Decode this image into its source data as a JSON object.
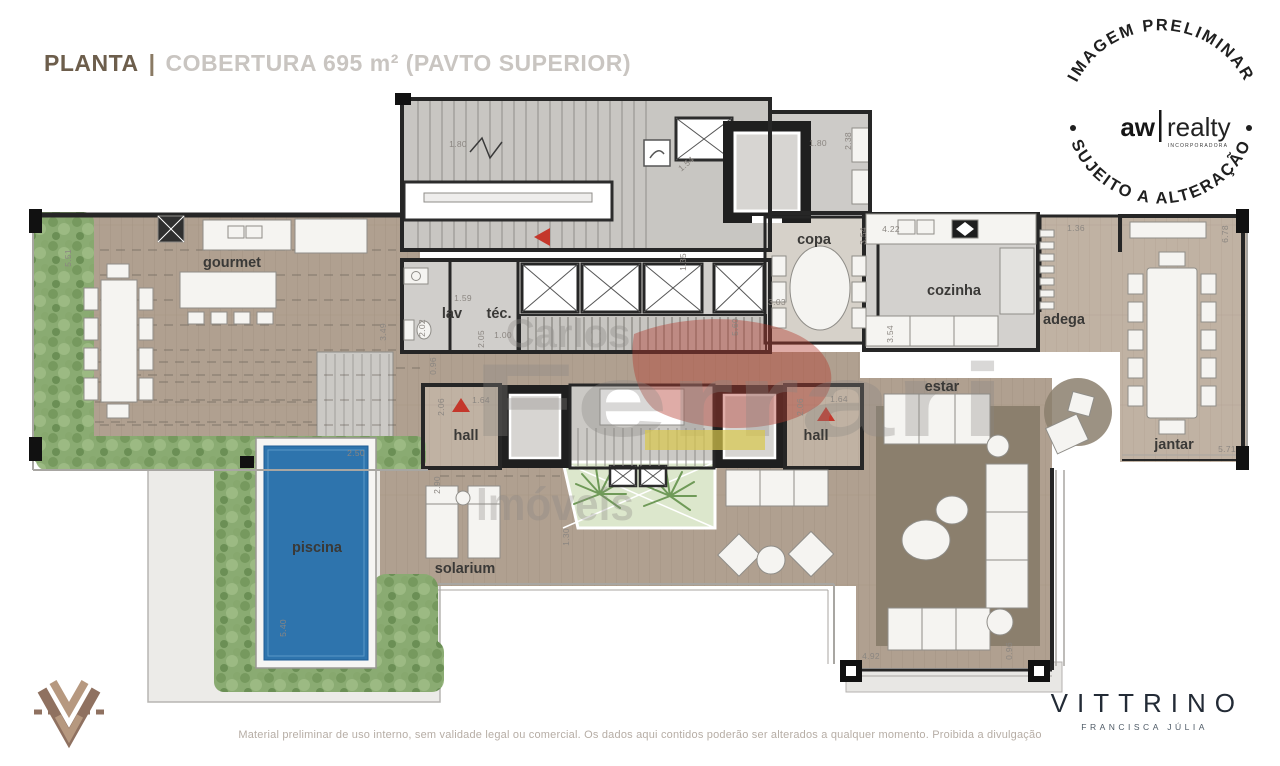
{
  "header": {
    "title_primary": "PLANTA",
    "separator": "|",
    "title_secondary": "COBERTURA 695 m² (PAVTO SUPERIOR)"
  },
  "badge": {
    "arc_top": "IMAGEM PRELIMINAR",
    "brand_left": "aw",
    "brand_right": "realty",
    "brand_sub": "INCORPORADORA",
    "arc_bottom": "SUJEITO A ALTERAÇÃO"
  },
  "plan": {
    "rooms": [
      {
        "id": "gourmet",
        "label": "gourmet",
        "x": 232,
        "y": 267
      },
      {
        "id": "lav",
        "label": "lav",
        "x": 452,
        "y": 318
      },
      {
        "id": "tec",
        "label": "téc.",
        "x": 499,
        "y": 318
      },
      {
        "id": "copa",
        "label": "copa",
        "x": 814,
        "y": 244
      },
      {
        "id": "cozinha",
        "label": "cozinha",
        "x": 954,
        "y": 295
      },
      {
        "id": "adega",
        "label": "adega",
        "x": 1064,
        "y": 324
      },
      {
        "id": "estar",
        "label": "estar",
        "x": 942,
        "y": 391
      },
      {
        "id": "jantar",
        "label": "jantar",
        "x": 1174,
        "y": 449
      },
      {
        "id": "hall-left",
        "label": "hall",
        "x": 466,
        "y": 440
      },
      {
        "id": "hall-right",
        "label": "hall",
        "x": 816,
        "y": 440
      },
      {
        "id": "piscina",
        "label": "piscina",
        "x": 317,
        "y": 552,
        "fill": "#1c3149"
      },
      {
        "id": "solarium",
        "label": "solarium",
        "x": 465,
        "y": 573
      }
    ],
    "dims": [
      {
        "v": "5.51",
        "x": 71,
        "y": 258,
        "r": -90
      },
      {
        "v": "1.80",
        "x": 458,
        "y": 147,
        "r": 0
      },
      {
        "v": "1.54",
        "x": 688,
        "y": 166,
        "r": -40
      },
      {
        "v": "1.80",
        "x": 818,
        "y": 146,
        "r": 0
      },
      {
        "v": "2.38",
        "x": 851,
        "y": 141,
        "r": -90
      },
      {
        "v": "1.35",
        "x": 686,
        "y": 262,
        "r": -90
      },
      {
        "v": "3.03",
        "x": 777,
        "y": 305,
        "r": 0
      },
      {
        "v": "5.60",
        "x": 738,
        "y": 327,
        "r": -90
      },
      {
        "v": "4.22",
        "x": 891,
        "y": 232,
        "r": 0
      },
      {
        "v": "3.54",
        "x": 866,
        "y": 236,
        "r": -90
      },
      {
        "v": "3.54",
        "x": 893,
        "y": 334,
        "r": -90
      },
      {
        "v": "1.36",
        "x": 1076,
        "y": 231,
        "r": 0
      },
      {
        "v": "6.78",
        "x": 1228,
        "y": 234,
        "r": -90
      },
      {
        "v": "5.71",
        "x": 1227,
        "y": 452,
        "r": 0
      },
      {
        "v": "1.59",
        "x": 463,
        "y": 301,
        "r": 0
      },
      {
        "v": "2.02",
        "x": 425,
        "y": 328,
        "r": -90
      },
      {
        "v": "2.05",
        "x": 484,
        "y": 339,
        "r": -90
      },
      {
        "v": "1.00",
        "x": 503,
        "y": 338,
        "r": 0
      },
      {
        "v": "0.96",
        "x": 436,
        "y": 366,
        "r": -90
      },
      {
        "v": "3.49",
        "x": 386,
        "y": 332,
        "r": -90
      },
      {
        "v": "2.06",
        "x": 444,
        "y": 407,
        "r": -90
      },
      {
        "v": "1.64",
        "x": 481,
        "y": 403,
        "r": 0
      },
      {
        "v": "2.06",
        "x": 803,
        "y": 407,
        "r": -90
      },
      {
        "v": "1.64",
        "x": 839,
        "y": 402,
        "r": 0
      },
      {
        "v": "2.90",
        "x": 440,
        "y": 485,
        "r": -90
      },
      {
        "v": "1.30",
        "x": 569,
        "y": 537,
        "r": -90
      },
      {
        "v": "2.50",
        "x": 356,
        "y": 456,
        "r": 0
      },
      {
        "v": "5.40",
        "x": 286,
        "y": 628,
        "r": -90
      },
      {
        "v": "4.92",
        "x": 871,
        "y": 659,
        "r": 0
      },
      {
        "v": "0.96",
        "x": 1012,
        "y": 651,
        "r": -90
      }
    ]
  },
  "watermark": {
    "line1": "Carlos",
    "line2": "Ferrari",
    "line3": "Imóveis"
  },
  "footer": {
    "disclaimer": "Material preliminar de uso interno, sem validade legal ou comercial. Os dados aqui contidos poderão ser alterados a qualquer momento. Proibida a divulgação",
    "brand": "VITTRINO",
    "brand_sub": "FRANCISCA JÚLIA"
  },
  "colors": {
    "deck_wood": "#b0a090",
    "interior_gray": "#cfcdca",
    "wall": "#262626",
    "pool": "#2e74ad",
    "greenery": "#8aab72",
    "red_marker": "#c4372b",
    "watermark_yellow": "#d8c84b",
    "watermark_red": "#b2392d"
  }
}
